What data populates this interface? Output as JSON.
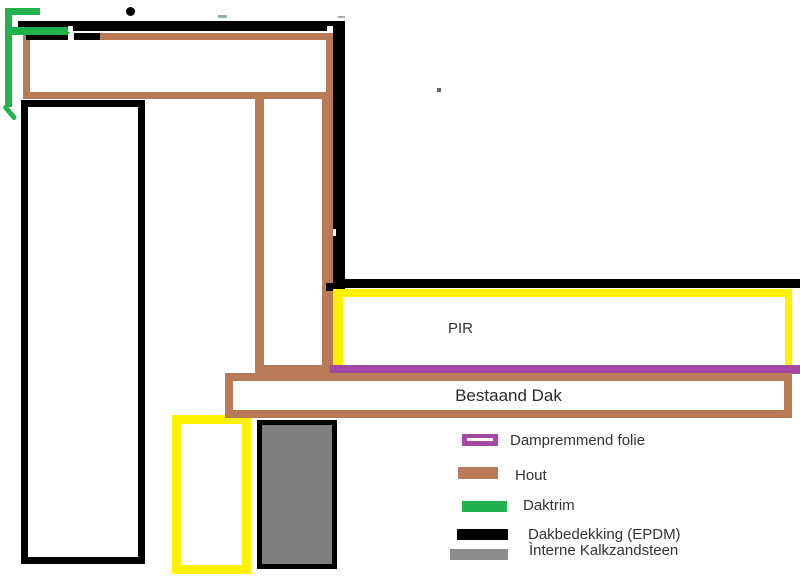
{
  "diagram": {
    "pir_label": "PIR",
    "bestaand_dak_label": "Bestaand Dak"
  },
  "legend": {
    "items": [
      {
        "label": "Dampremmend folie",
        "color_key": "purple"
      },
      {
        "label": "Hout",
        "color_key": "brown"
      },
      {
        "label": "Daktrim",
        "color_key": "green"
      },
      {
        "label": "Dakbedekking (EPDM)",
        "color_key": "black"
      },
      {
        "label": "Ìnterne Kalkzandsteen",
        "color_key": "gray_swatch"
      }
    ]
  },
  "colors": {
    "purple": "#A349A4",
    "brown": "#B97A57",
    "green": "#22B14C",
    "yellow": "#FFF200",
    "black": "#000000",
    "gray_fill": "#7F7F7F",
    "gray_swatch": "#8C8C8C",
    "text": "#333333"
  }
}
